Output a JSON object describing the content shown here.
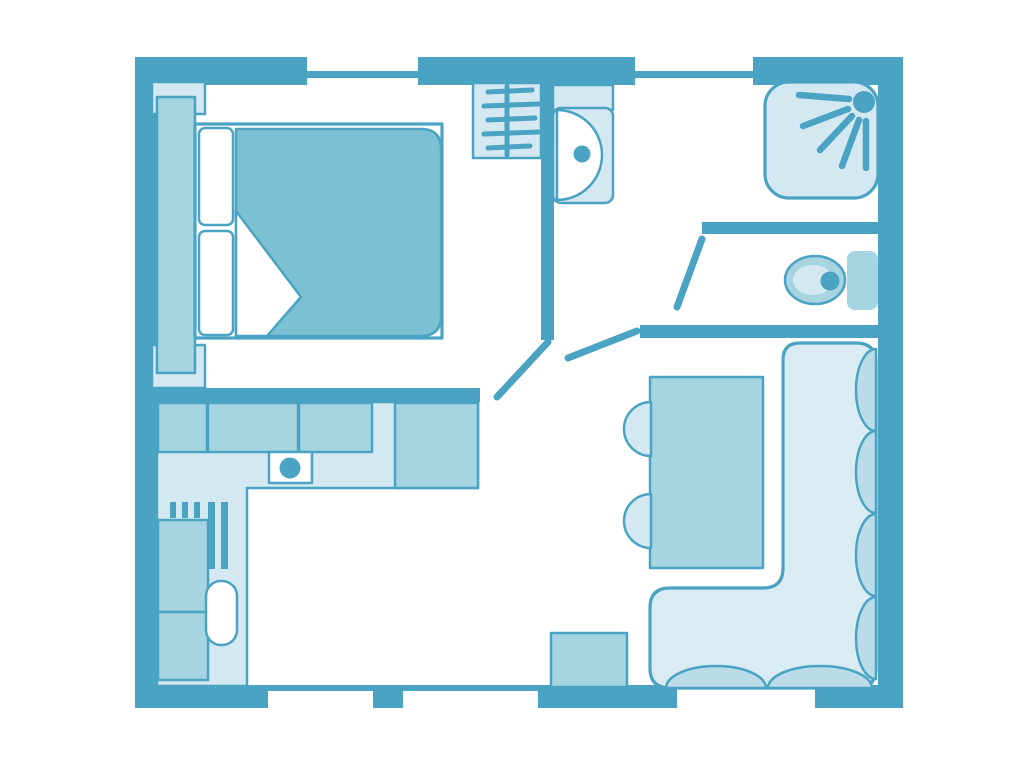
{
  "title": "Apartment floor plan with bedroom, bathroom, WC, kitchen and living room",
  "palette": {
    "wall": "#4BA3C3",
    "light": "#D3E8F0",
    "medium": "#A6D4E1",
    "dark": "#7CC0D4",
    "sofa": "#D9ECF3",
    "cushion": "#B9DCE8",
    "background": "#FFFFFF"
  },
  "rooms": [
    {
      "name": "bedroom",
      "fixtures": [
        "double-bed",
        "pillows",
        "duvet",
        "wardrobe",
        "nightstands"
      ]
    },
    {
      "name": "bathroom",
      "fixtures": [
        "closet-with-hangers",
        "washbasin",
        "shower"
      ]
    },
    {
      "name": "wc",
      "fixtures": [
        "toilet",
        "cistern"
      ]
    },
    {
      "name": "kitchen",
      "fixtures": [
        "l-shaped-counter",
        "cabinets",
        "sink",
        "refrigerator",
        "radiator"
      ]
    },
    {
      "name": "living-room",
      "fixtures": [
        "dining-table",
        "two-chairs",
        "corner-sofa",
        "side-table"
      ]
    }
  ],
  "openings": {
    "windows_top": 2,
    "windows_bottom": 2,
    "interior_doors": 3
  }
}
